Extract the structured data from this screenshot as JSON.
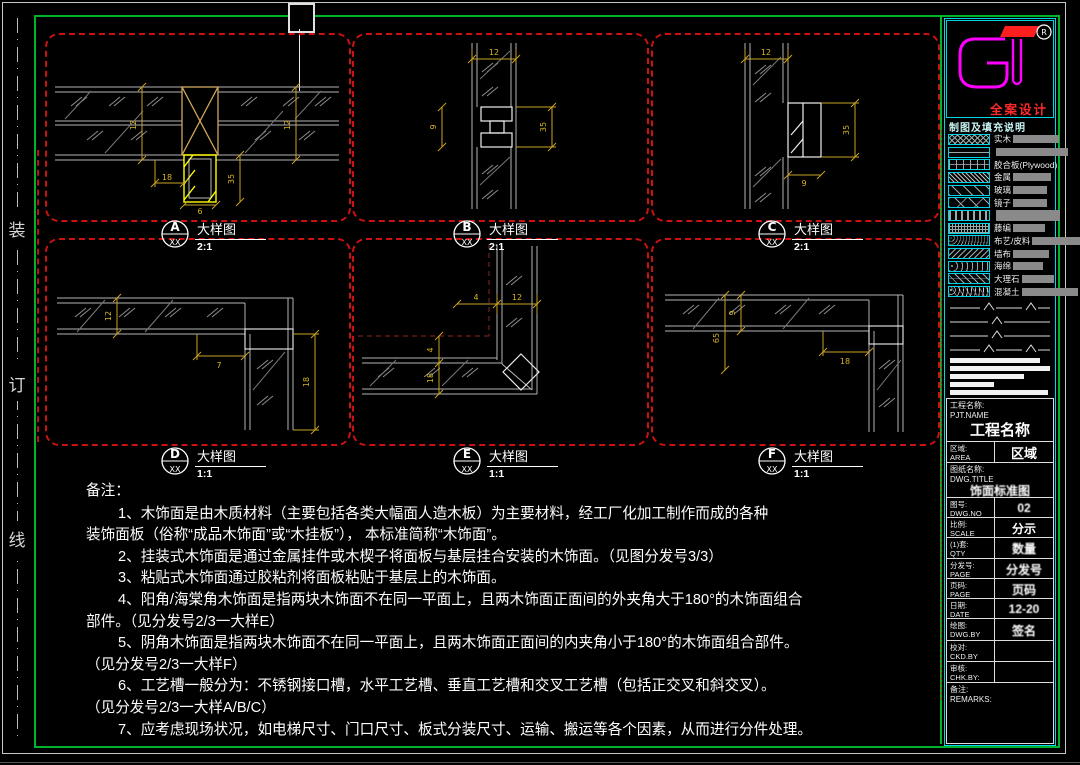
{
  "colors": {
    "accent_red": "#cc1111",
    "dim_gold": "#c9a227",
    "cad_yellow": "#ffff00",
    "frame_green": "#00b32c",
    "panel_cyan": "#00d5e8",
    "logo_magenta": "#ff00ff",
    "brand_red": "#ff2a2a"
  },
  "binding_strip": {
    "chars": [
      "装",
      "订",
      "线"
    ]
  },
  "details": {
    "A": {
      "letter": "A",
      "ref": "XX",
      "title": "大样图",
      "scale": "2:1",
      "dims": [
        "12",
        "12",
        "18",
        "6",
        "35"
      ]
    },
    "B": {
      "letter": "B",
      "ref": "XX",
      "title": "大样图",
      "scale": "2:1",
      "dims": [
        "12",
        "9",
        "35"
      ]
    },
    "C": {
      "letter": "C",
      "ref": "XX",
      "title": "大样图",
      "scale": "2:1",
      "dims": [
        "12",
        "35",
        "9"
      ]
    },
    "D": {
      "letter": "D",
      "ref": "XX",
      "title": "大样图",
      "scale": "1:1",
      "dims": [
        "12",
        "7",
        "18"
      ]
    },
    "E": {
      "letter": "E",
      "ref": "XX",
      "title": "大样图",
      "scale": "1:1",
      "dims": [
        "4",
        "12",
        "4",
        "18"
      ]
    },
    "F": {
      "letter": "F",
      "ref": "XX",
      "title": "大样图",
      "scale": "1:1",
      "dims": [
        "9",
        "65",
        "18"
      ]
    }
  },
  "notes": {
    "heading": "备注：",
    "lines": [
      {
        "t": "1、木饰面是由木质材料（主要包括各类大幅面人造木板）为主要材料，经工厂化加工制作而成的各种",
        "ind": 1
      },
      {
        "t": "装饰面板（俗称“成品木饰面”或“木挂板”）， 本标准简称“木饰面”。",
        "ind": 0
      },
      {
        "t": "2、挂装式木饰面是通过金属挂件或木楔子将面板与基层挂合安装的木饰面。（见图分发号3/3）",
        "ind": 1
      },
      {
        "t": "3、粘贴式木饰面通过胶粘剂将面板粘贴于基层上的木饰面。",
        "ind": 1
      },
      {
        "t": "4、阳角/海棠角木饰面是指两块木饰面不在同一平面上，且两木饰面正面间的外夹角大于180°的木饰面组合",
        "ind": 1
      },
      {
        "t": "部件。（见分发号2/3一大样E）",
        "ind": 0
      },
      {
        "t": "5、阴角木饰面是指两块木饰面不在同一平面上，且两木饰面正面间的内夹角小于180°的木饰面组合部件。",
        "ind": 1
      },
      {
        "t": "（见分发号2/3一大样F）",
        "ind": 0
      },
      {
        "t": "6、工艺槽一般分为：不锈钢接口槽，水平工艺槽、垂直工艺槽和交叉工艺槽（包括正交叉和斜交叉）。",
        "ind": 1
      },
      {
        "t": "（见分发号2/3一大样A/B/C）",
        "ind": 0
      },
      {
        "t": "7、应考虑现场状况，如电梯尺寸、门口尺寸、板式分装尺寸、运输、搬运等各个因素，从而进行分件处理。",
        "ind": 1
      }
    ]
  },
  "right_panel": {
    "logo": {
      "text": "GT",
      "registered": "R",
      "subtitle": "全案设计"
    },
    "legend": {
      "title": "制图及填充说明",
      "items": [
        {
          "label": "实木"
        },
        {
          "label": ""
        },
        {
          "label": "胶合板(Plywood)"
        },
        {
          "label": "金属"
        },
        {
          "label": "玻璃"
        },
        {
          "label": "镜子"
        },
        {
          "label": ""
        },
        {
          "label": "藤编"
        },
        {
          "label": "布艺/皮料"
        },
        {
          "label": "墙布"
        },
        {
          "label": "海绵"
        },
        {
          "label": "大理石"
        },
        {
          "label": "混凝土"
        }
      ]
    },
    "title_block": {
      "project": {
        "label": "工程名称:",
        "label_en": "PJT.NAME",
        "value": "工程名称"
      },
      "area": {
        "label": "区域:",
        "label_en": "AREA",
        "value": "区域"
      },
      "drawing_title": {
        "label": "图纸名称:",
        "label_en": "DWG.TITLE",
        "value": "饰面标准图"
      },
      "rows": [
        {
          "label": "图号:",
          "label_en": "DWG.NO",
          "value": "02"
        },
        {
          "label": "比例:",
          "label_en": "SCALE",
          "value": "分示"
        },
        {
          "label": "(1)套:",
          "label_en": "QTY",
          "value": "数量"
        },
        {
          "label": "分发号:",
          "label_en": "PAGE",
          "value": "分发号"
        },
        {
          "label": "页码:",
          "label_en": "PAGE",
          "value": "页码"
        },
        {
          "label": "日期:",
          "label_en": "DATE",
          "value": "12-20"
        },
        {
          "label": "绘图:",
          "label_en": "DWG.BY",
          "value": "签名"
        },
        {
          "label": "校对:",
          "label_en": "CKD.BY",
          "value": ""
        },
        {
          "label": "审核:",
          "label_en": "CHK.BY:",
          "value": ""
        }
      ],
      "remarks": {
        "label": "备注:",
        "label_en": "REMARKS:",
        "value": ""
      }
    }
  }
}
